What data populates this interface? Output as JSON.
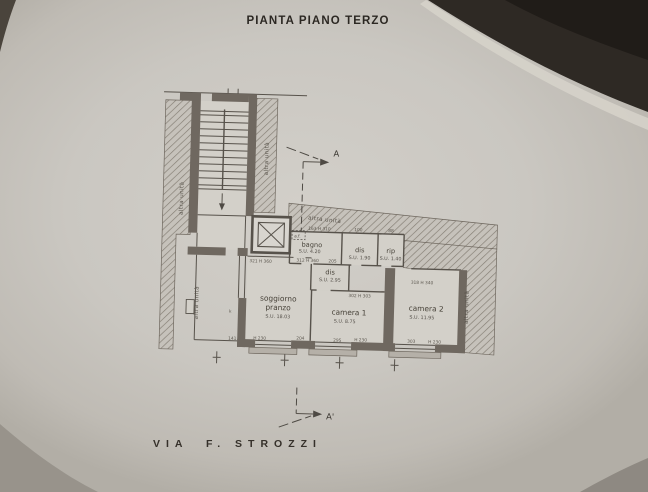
{
  "colors": {
    "paper": "#cac7c1",
    "corner_shadow": "#2e2924",
    "wall": "#6f6860",
    "line": "#57524b",
    "sill": "#b5b0a8"
  },
  "title": "PIANTA PIANO TERZO",
  "street": "VIA  F. STROZZI",
  "section": {
    "top": "A",
    "bottom": "A'"
  },
  "neighbor": "altra unità",
  "rooms": {
    "bagno": {
      "name": "bagno",
      "area": "S.U. 4.20"
    },
    "dis1": {
      "name": "dis",
      "area": "S.U. 1.90"
    },
    "rip": {
      "name": "rip",
      "area": "S.U. 1.40"
    },
    "dis2": {
      "name": "dis",
      "area": "S.U. 2.95"
    },
    "soggiorno": {
      "name": "soggiorno",
      "name2": "pranzo",
      "area": "S.U. 18.03"
    },
    "camera1": {
      "name": "camera 1",
      "area": "S.U. 8.75"
    },
    "camera2": {
      "name": "camera 2",
      "area": "S.U. 11.95"
    }
  },
  "dims": [
    "163 H 310",
    "100",
    "88",
    "a.f.",
    "312 H 360",
    "205",
    "321 H 360",
    "302 H 303",
    "318 H 340",
    "141",
    "H 230",
    "204",
    "295",
    "H 230",
    "303",
    "H 230",
    "k"
  ]
}
